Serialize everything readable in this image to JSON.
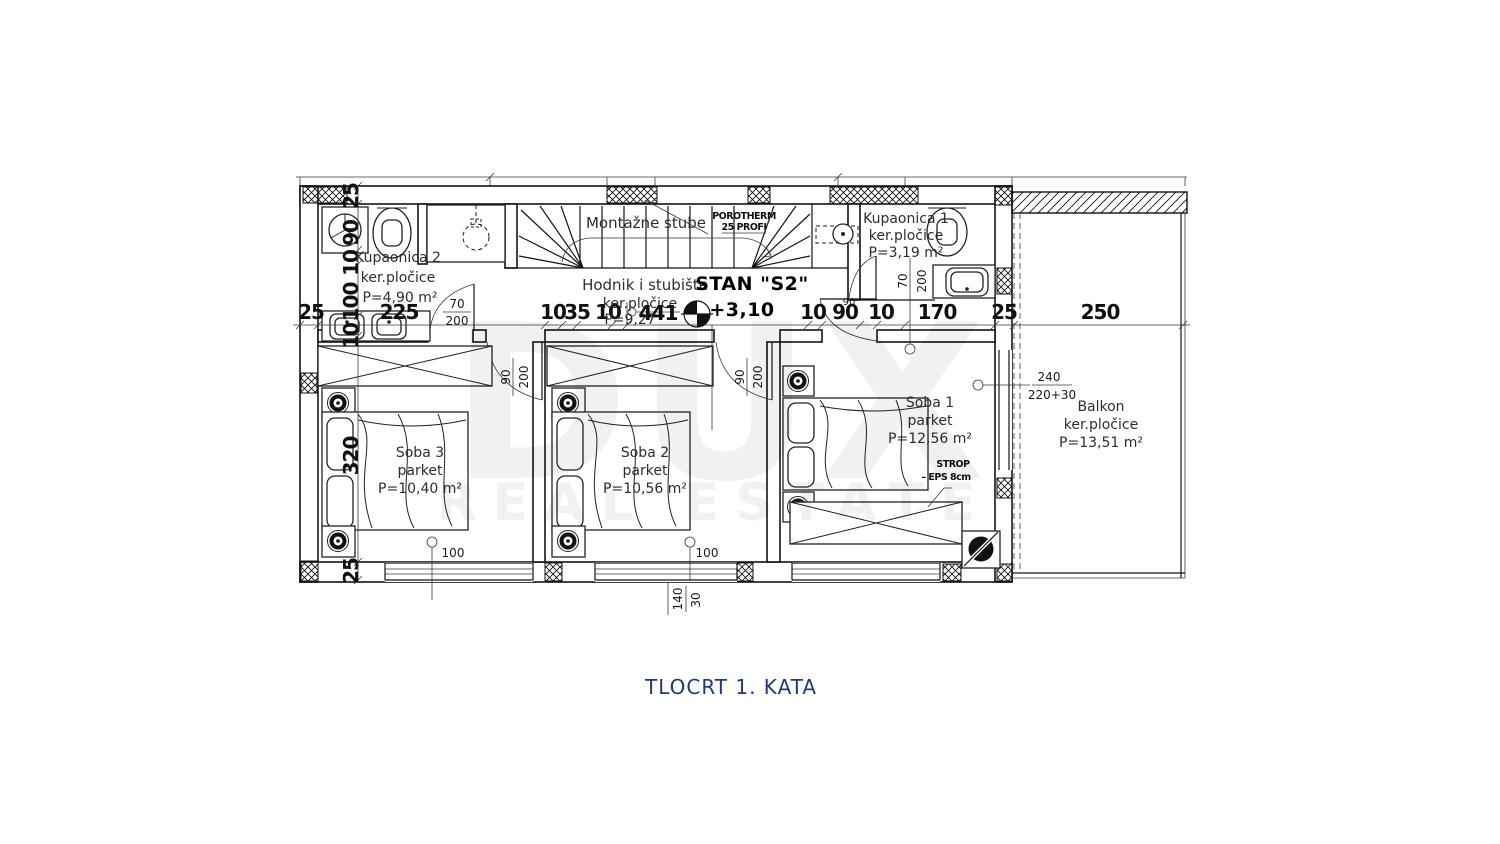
{
  "title": "TLOCRT 1. KATA",
  "watermark": {
    "line1": "DUX",
    "line2": "REAL ESTATE"
  },
  "apartment": {
    "label": "STAN \"S2\"",
    "level": "+3,10"
  },
  "stairs": {
    "label": "Montažne stube"
  },
  "wall_spec": {
    "line1": "POROTHERM",
    "line2": "25 PROFI"
  },
  "ceiling": {
    "line1": "STROP",
    "line2": "–  EPS 8cm"
  },
  "rooms": {
    "kupaonica2": {
      "name": "Kupaonica 2",
      "floor": "ker.pločice",
      "area": "P=4,90 m²"
    },
    "kupaonica1": {
      "name": "Kupaonica 1",
      "floor": "ker.pločice",
      "area": "P=3,19 m²"
    },
    "hodnik": {
      "name": "Hodnik i stubište",
      "floor": "ker.pločice",
      "area": "P=9,27"
    },
    "soba3": {
      "name": "Soba 3",
      "floor": "parket",
      "area": "P=10,40 m²"
    },
    "soba2": {
      "name": "Soba 2",
      "floor": "parket",
      "area": "P=10,56 m²"
    },
    "soba1": {
      "name": "Soba 1",
      "floor": "parket",
      "area": "P=12,56 m²"
    },
    "balkon": {
      "name": "Balkon",
      "floor": "ker.pločice",
      "area": "P=13,51 m²"
    }
  },
  "dims": {
    "h": [
      "25",
      "225",
      "10",
      "35",
      "10",
      "441",
      "10",
      "90",
      "10",
      "170",
      "25",
      "250"
    ],
    "v_left": [
      "25",
      "90",
      "10",
      "100",
      "10",
      "320",
      "25"
    ],
    "door_k2": [
      "70",
      "200"
    ],
    "door_s3": [
      "90",
      "200"
    ],
    "door_s2": [
      "90",
      "200"
    ],
    "door_k1": [
      "70",
      "200"
    ],
    "small_90": "90",
    "win": [
      "100",
      "100"
    ],
    "bottom": [
      "140",
      "30"
    ],
    "balcony_spec": [
      "240",
      "220+30"
    ]
  }
}
